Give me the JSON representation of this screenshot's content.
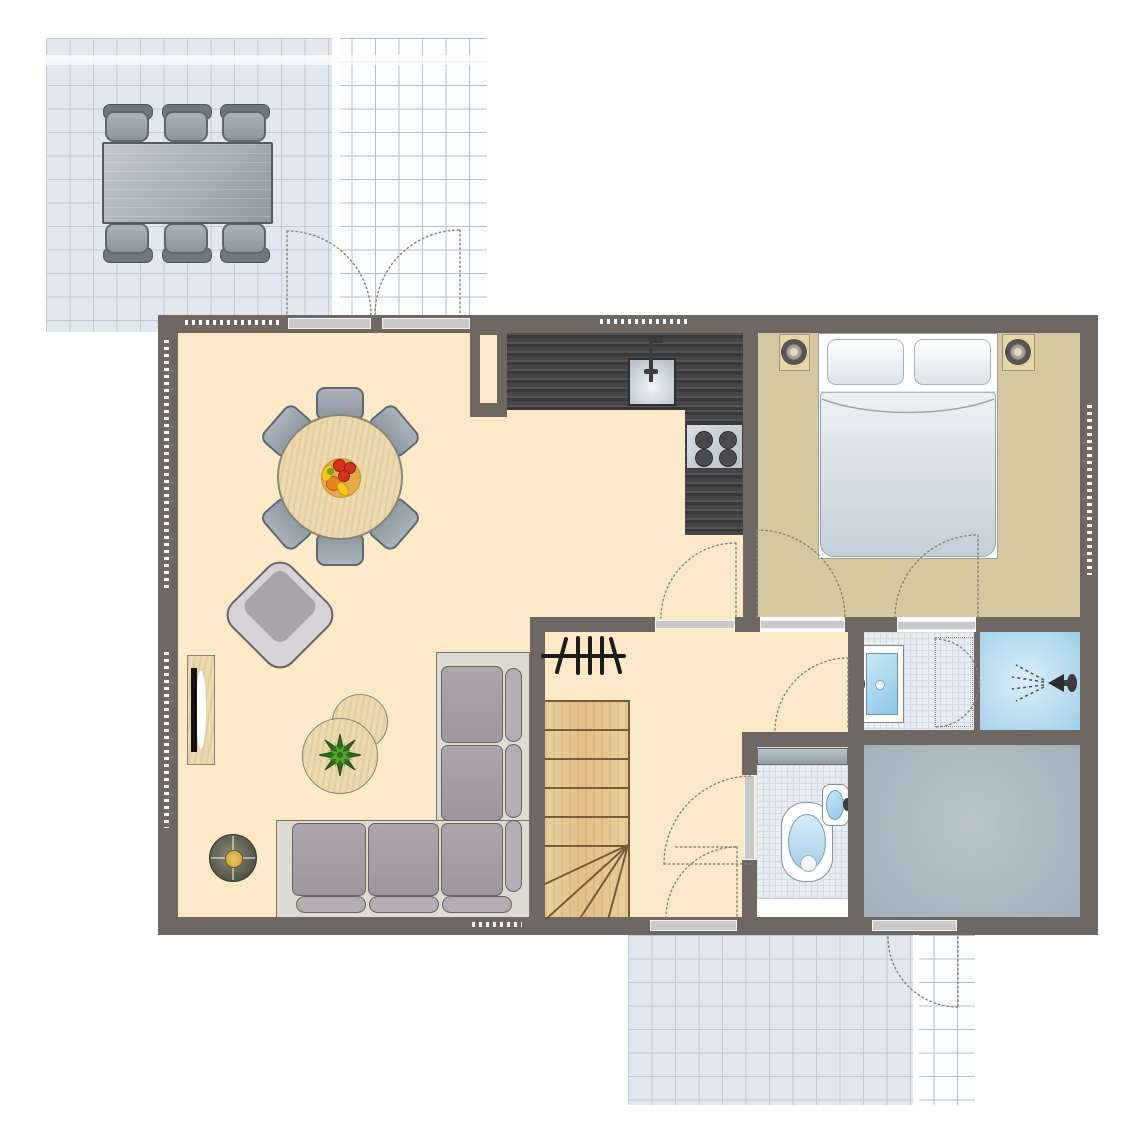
{
  "title": "house-ground-floor-plan",
  "colors": {
    "wall": "#6f6862",
    "livingFloor": "#fbe9c7",
    "bedroomFloor": "#d6c9a2",
    "bathTile": "#e9eef4",
    "tileLine": "#d3dde8",
    "showerA": "#dceef9",
    "showerB": "#9fcfe9",
    "utilityA": "#b9c4cb",
    "utilityB": "#a1afb8",
    "terrLine": "#b8c1cb",
    "terrShade": "rgba(202,212,226,0.5)",
    "win": "#c9c9c9",
    "winEdge": "#f2f2f2",
    "counter": "#454547",
    "stairWood": "#ebce9e",
    "stairLine": "#7a5a38",
    "tableWood": "#ecd9ad",
    "woodEdge": "#8a8578",
    "chairA": "#aab3bb",
    "chairB": "#8b959d",
    "chairEdge": "#5f6870",
    "sofaBase": "#dcdcd3",
    "sofaEdge": "#72706a",
    "cushionA": "#aca6ac",
    "cushionB": "#9d979d",
    "bolster": "#b3adb3",
    "cushionEdge": "#6b6560",
    "armLight": "#d7d4d7",
    "armSeat": "#a9a4aa",
    "bedEdge": "#9aa0a4",
    "duvetA": "#eef2f4",
    "duvetB": "#c5d0d7",
    "nightWood": "#e9d7ab",
    "basinA": "#c8e7f6",
    "basinB": "#8ec7e6",
    "fixtureEdge": "#8a9096",
    "arc": "#8a8274",
    "radiator": "#1c1c1c",
    "plantDark": "#2f6d1f",
    "plantLight": "#57a22e",
    "bowl": "#e2aa4a",
    "fruitRed": "#d4301f",
    "fruitOrange": "#e8821e",
    "fruitYellow": "#f2c81e",
    "lampDark": "#55584a",
    "lampGold": "#caa136",
    "metal": "#3c3c3e"
  },
  "rooms": [
    {
      "id": "terrace-top",
      "type": "terrace",
      "furniture": [
        "outdoor-dining-table",
        "outdoor-chair x6"
      ]
    },
    {
      "id": "living-dining-room",
      "type": "living",
      "furniture": [
        "round-dining-table",
        "dining-chair x6",
        "fruit-bowl",
        "armchair",
        "tv-cabinet",
        "coffee-table x2",
        "potted-plant",
        "corner-sofa",
        "side-lamp-table",
        "radiator"
      ]
    },
    {
      "id": "kitchen",
      "type": "kitchen",
      "furniture": [
        "l-shaped-counter",
        "sink",
        "faucet",
        "cooktop-4-burners",
        "duct-shaft"
      ]
    },
    {
      "id": "bedroom",
      "type": "bedroom",
      "furniture": [
        "double-bed",
        "pillow x2",
        "nightstand x2"
      ]
    },
    {
      "id": "hallway",
      "type": "hall",
      "furniture": [
        "staircase-with-winder",
        "radiator-symbol"
      ]
    },
    {
      "id": "bathroom",
      "type": "bath",
      "furniture": [
        "washbasin",
        "swing-door",
        "shower"
      ]
    },
    {
      "id": "toilet-room",
      "type": "wc",
      "furniture": [
        "toilet",
        "corner-washbasin",
        "shelf"
      ]
    },
    {
      "id": "utility-room",
      "type": "storage",
      "furniture": []
    },
    {
      "id": "terrace-bottom",
      "type": "terrace",
      "furniture": []
    }
  ],
  "doors": [
    "french-doors-terrace x2",
    "kitchen-hall-door",
    "bedroom-door",
    "bedroom-bathroom-door",
    "hall-bathroom-door",
    "toilet-door",
    "back-door",
    "utility-terrace-door"
  ],
  "windows_and_thresholds": 7,
  "text": {}
}
